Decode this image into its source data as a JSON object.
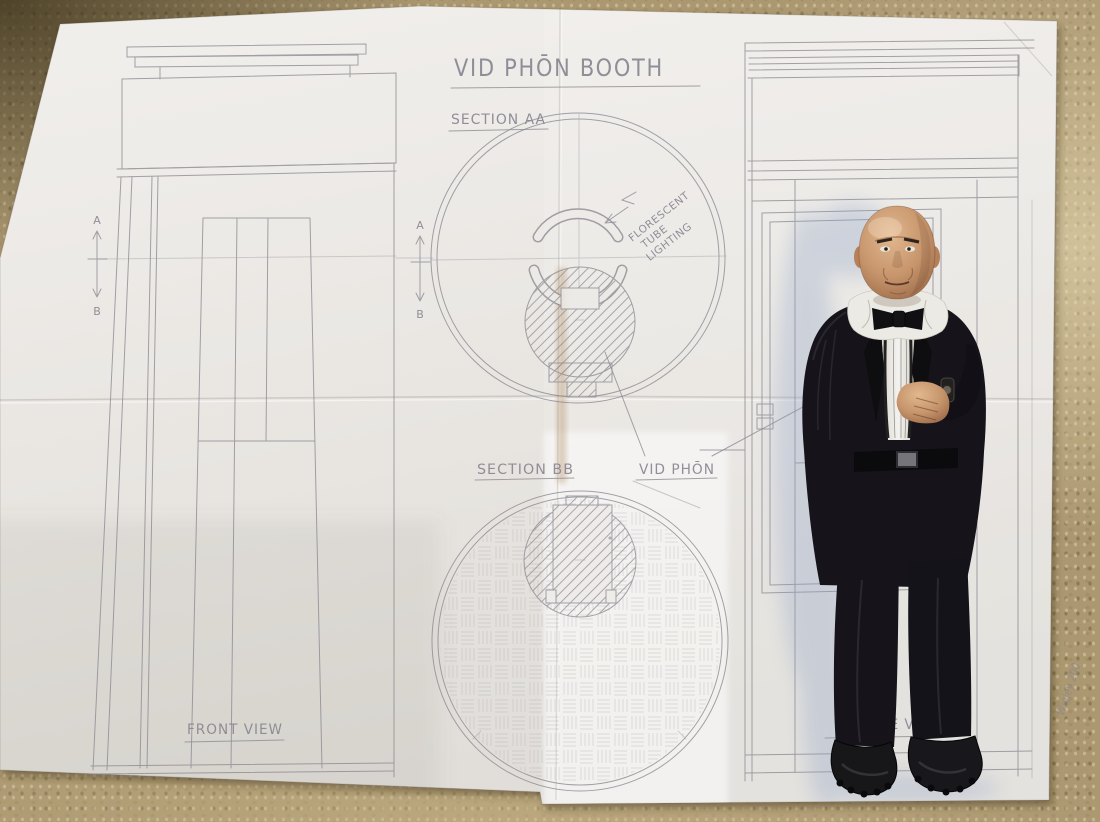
{
  "labels": {
    "title": "VID PHŌN BOOTH",
    "section_aa": "SECTION AA",
    "section_bb": "SECTION BB",
    "vid_phon": "VID PHŌN",
    "front_view": "FRONT VIEW",
    "profile_view": "PROFILE VIEW",
    "lighting_note": [
      "FLORESCENT",
      "TUBE",
      "LIGHTING"
    ],
    "marker_a": "A",
    "marker_b": "B",
    "signature": "Wigley 200"
  },
  "colors": {
    "carpet": "#ab9870",
    "paper": "#ebe8e5",
    "pencil": "#8e8b94",
    "suit_black": "#16141a",
    "skin": "#c9976e",
    "shirt_white": "#eceae5",
    "cast_shadow_blue": "#8fa3c6"
  }
}
